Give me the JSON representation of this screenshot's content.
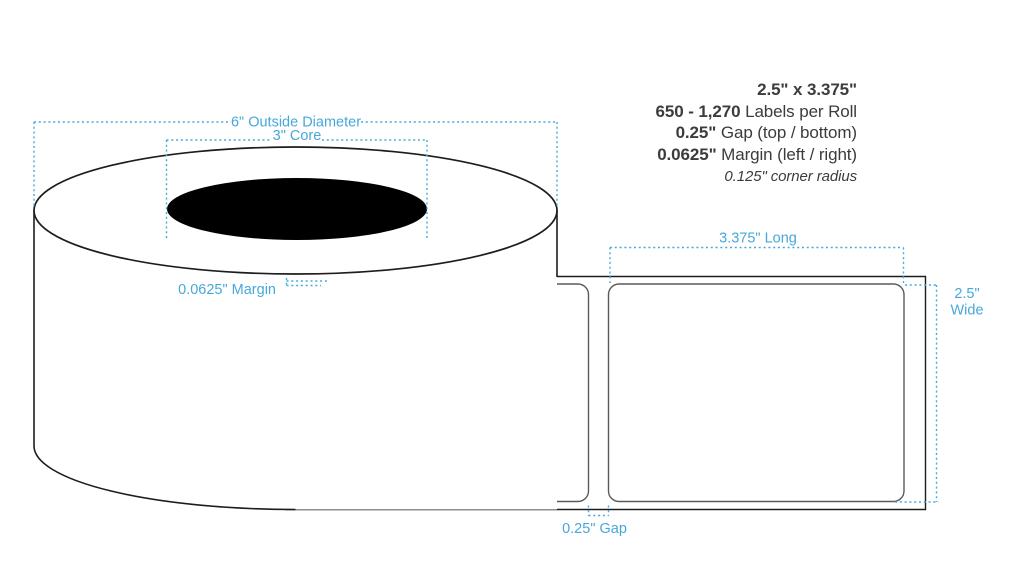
{
  "title_block": {
    "size": "2.5\" x 3.375\"",
    "count_value": "650 - 1,270",
    "count_label": " Labels per Roll",
    "gap_value": "0.25\"",
    "gap_label": " Gap (top / bottom)",
    "margin_value": "0.0625\"",
    "margin_label": " Margin (left / right)",
    "corner_radius_note": "0.125\" corner radius"
  },
  "dimensions": {
    "outside_diameter": "6\" Outside Diameter",
    "core": "3\" Core",
    "margin": "0.0625\" Margin",
    "label_length": "3.375\" Long",
    "label_width_line1": "2.5\"",
    "label_width_line2": "Wide",
    "gap": "0.25\" Gap"
  },
  "colors": {
    "dimension_blue": "#47a8db",
    "text_dark": "#3c3c3e",
    "label_outline_gray": "#5a5a5c",
    "diagram_outline_black": "#1d1d1f",
    "core_fill_black": "#000000",
    "background": "#ffffff"
  }
}
